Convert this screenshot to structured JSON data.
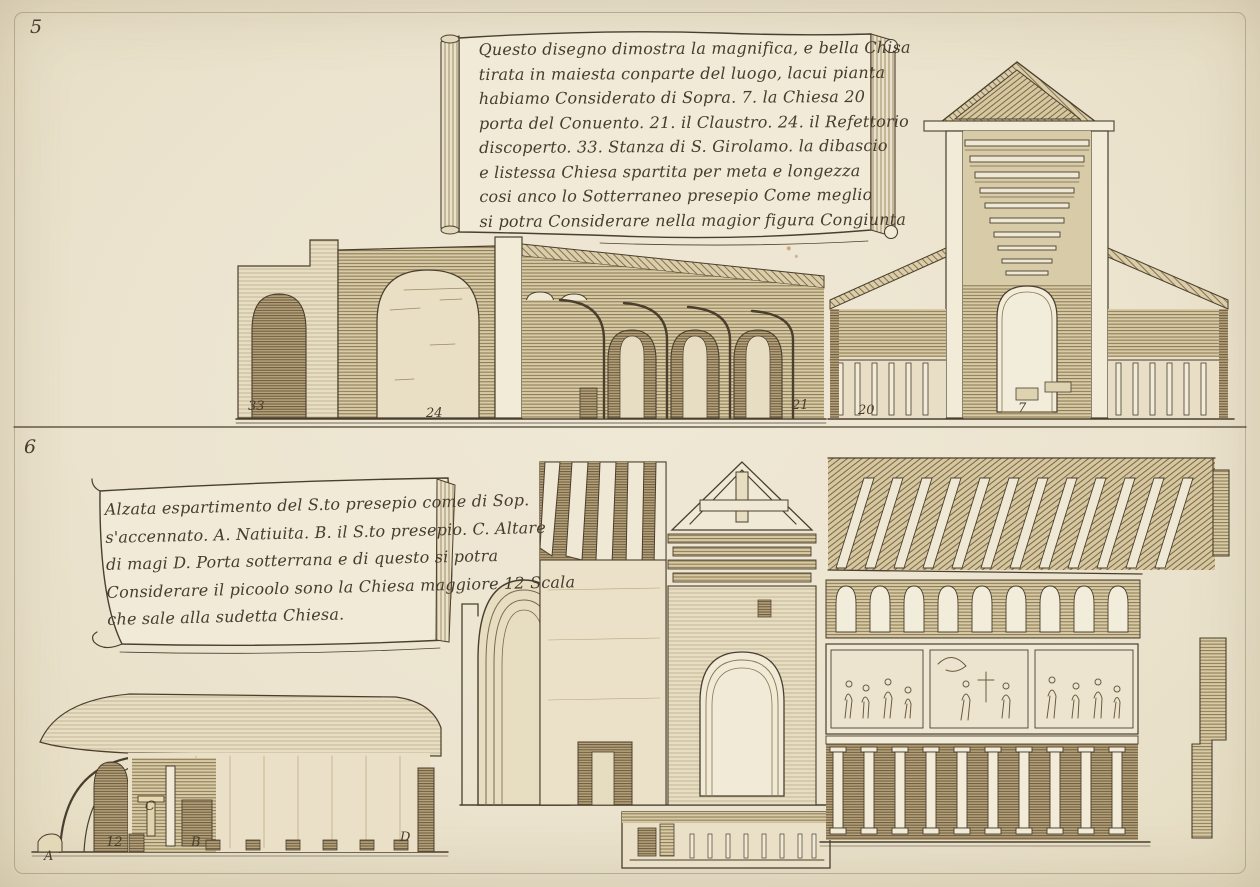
{
  "artwork": {
    "paper_color": "#ece4cf",
    "ink_color": "#473c2d"
  },
  "plate_top": {
    "number": "5",
    "cartouche": {
      "lines": [
        "Questo disegno dimostra la magnifica, e bella Chisa",
        "tirata in maiesta conparte del luogo, lacui pianta",
        "habiamo Considerato di Sopra. 7. la Chiesa 20",
        "porta del Conuento. 21. il Claustro. 24. il Refettorio",
        "discoperto. 33. Stanza di S. Girolamo. la dibascio",
        "e listessa Chiesa spartita per meta e longezza",
        "cosi anco lo Sotterraneo presepio Come meglio",
        "si potra Considerare nella magior figura Congiunta"
      ]
    },
    "labels": {
      "refettorio": "33",
      "claustro": "24",
      "cloister_end": "21",
      "porta_convento": "20",
      "chiesa": "7"
    }
  },
  "plate_bottom": {
    "number": "6",
    "cartouche": {
      "lines": [
        "Alzata espartimento del S.to presepio come di Sop.",
        "s'accennato. A. Natiuita. B. il S.to presepio. C. Altare",
        "di magi D. Porta sotterrana e di questo si potra",
        "Considerare il picoolo sono la Chiesa maggiore 12 Scala",
        "che sale alla sudetta Chiesa."
      ]
    },
    "labels": {
      "natiuita": "A",
      "scala": "12",
      "altare_magi": "C",
      "presepio": "B",
      "porta_sotterrana": "D"
    }
  }
}
